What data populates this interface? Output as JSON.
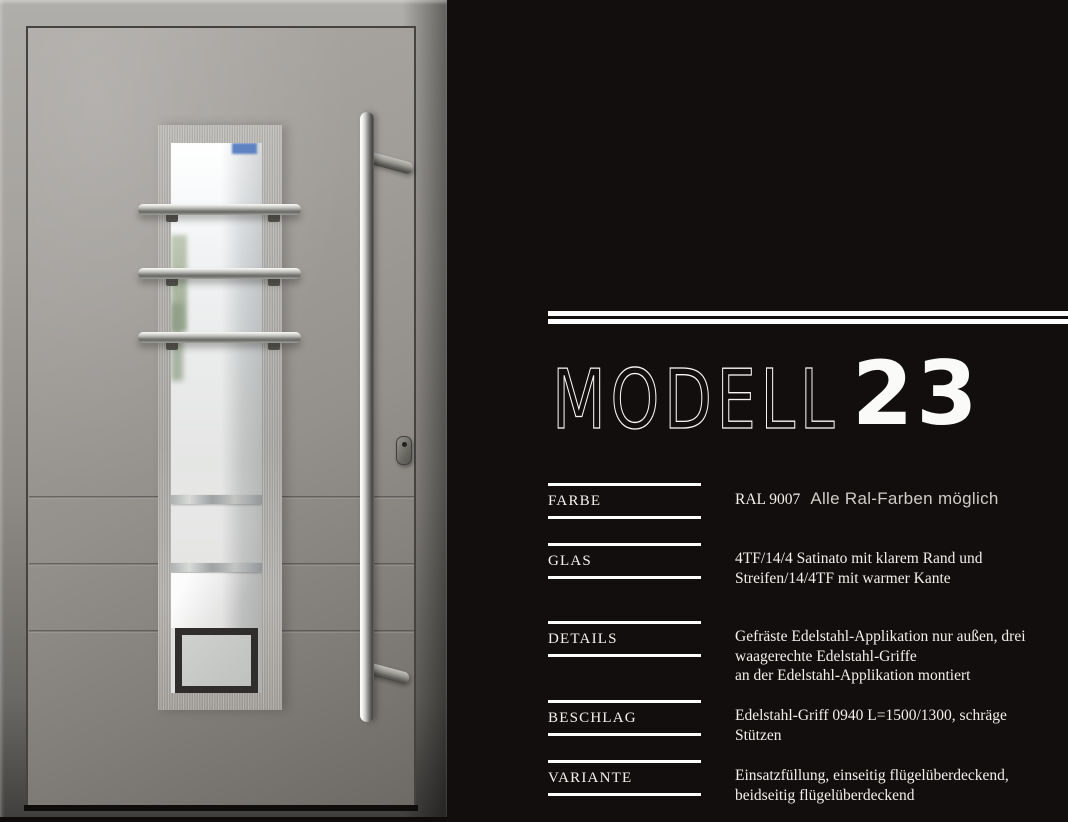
{
  "page": {
    "background": "#120e0d",
    "accent_white": "#ffffff"
  },
  "door_photo": {
    "alt": "Gray aluminium entrance door with brushed stainless-steel application, satinato glass strip, three horizontal steel bars and a long vertical pull handle",
    "colors": {
      "door": "#9b9894",
      "frame": "#8e8b87",
      "steel_application": "#b1afab",
      "glass": "#eceff1",
      "handle": "#d9d9d6"
    }
  },
  "header": {
    "title": "MODELL",
    "number": "23"
  },
  "specs": {
    "rows": [
      {
        "label": "FARBE",
        "code": "RAL 9007",
        "note": "Alle Ral-Farben möglich"
      },
      {
        "label": "GLAS",
        "value": "4TF/14/4 Satinato mit klarem Rand und\nStreifen/14/4TF mit warmer Kante"
      },
      {
        "label": "DETAILS",
        "value": "Gefräste Edelstahl-Applikation nur außen, drei\nwaagerechte Edelstahl-Griffe\nan der Edelstahl-Applikation montiert"
      },
      {
        "label": "BESCHLAG",
        "value": "Edelstahl-Griff 0940 L=1500/1300, schräge\nStützen"
      },
      {
        "label": "VARIANTE",
        "value": "Einsatzfüllung, einseitig flügelüberdeckend,\nbeidseitig flügelüberdeckend"
      }
    ]
  }
}
